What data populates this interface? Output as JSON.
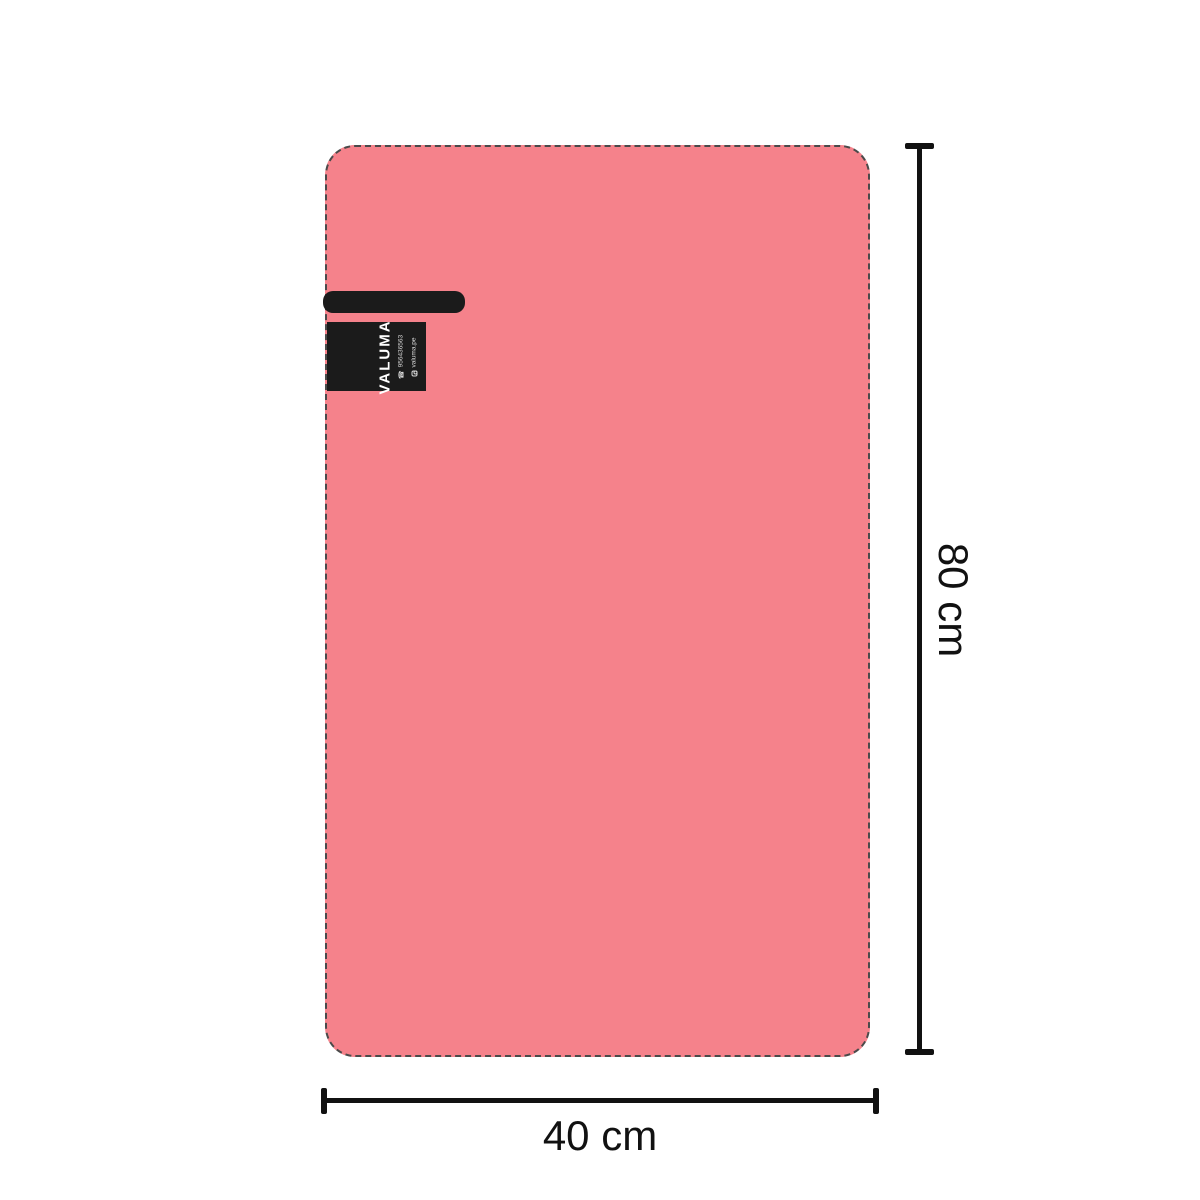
{
  "scene": {
    "description": "Product dimension diagram of a pink blanket with brand tag",
    "background_color": "#ffffff"
  },
  "blanket": {
    "fill_color": "#F5828B",
    "border_color": "#4a4a4a",
    "border_style": "dashed"
  },
  "tag": {
    "background_color": "#1b1b1b",
    "brand": "VALUMA",
    "phone": "956436563",
    "instagram": "valuma.pe",
    "phone_icon_glyph": "☎",
    "instagram_icon_glyph": "css-rounded-square-with-dot"
  },
  "dimensions": {
    "height_label": "80 cm",
    "width_label": "40 cm",
    "line_color": "#111111"
  }
}
